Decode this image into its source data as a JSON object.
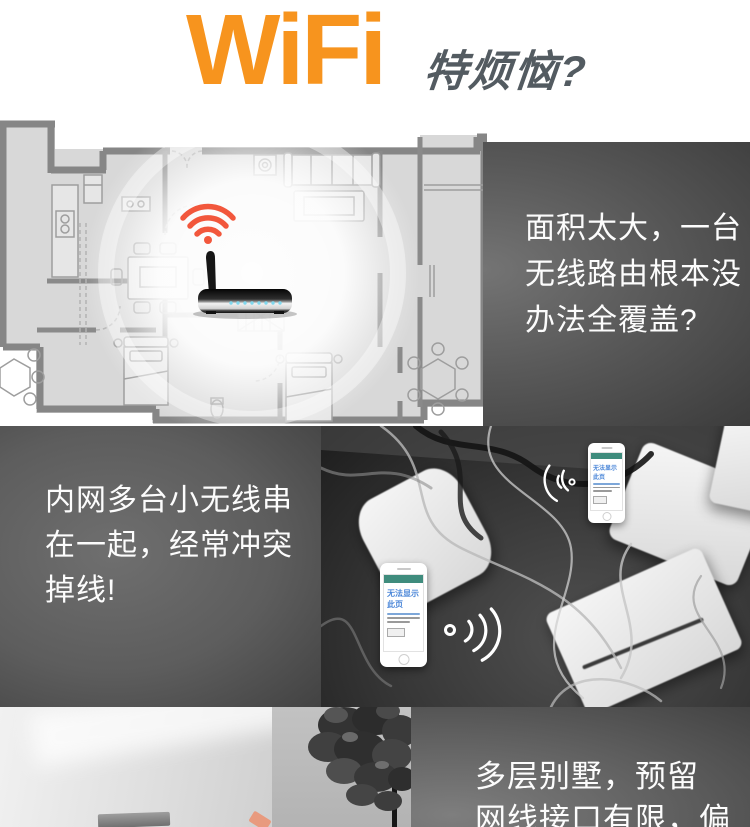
{
  "header": {
    "brand": "WiFi",
    "tagline": "特烦恼?",
    "brand_color": "#F7941E",
    "tagline_color": "#535B61"
  },
  "pain_points": {
    "coverage": {
      "lines": [
        "面积太大，一台",
        "无线路由根本没",
        "办法全覆盖?"
      ]
    },
    "conflict": {
      "lines": [
        "内网多台小无线串",
        "在一起，经常冲突",
        "掉线!"
      ]
    },
    "villa": {
      "lines": [
        "多层别墅，预留",
        "网线接口有限，偏"
      ]
    }
  },
  "phone": {
    "error_title": "无法显示此页"
  },
  "illustration_colors": {
    "wifi_signal_red": "#F2573C",
    "router_led_blue": "#7FD8EE",
    "floorplan_wall_gray": "#868686",
    "panel_gray_light": "#717171",
    "panel_gray_dark": "#3D3D3D"
  }
}
